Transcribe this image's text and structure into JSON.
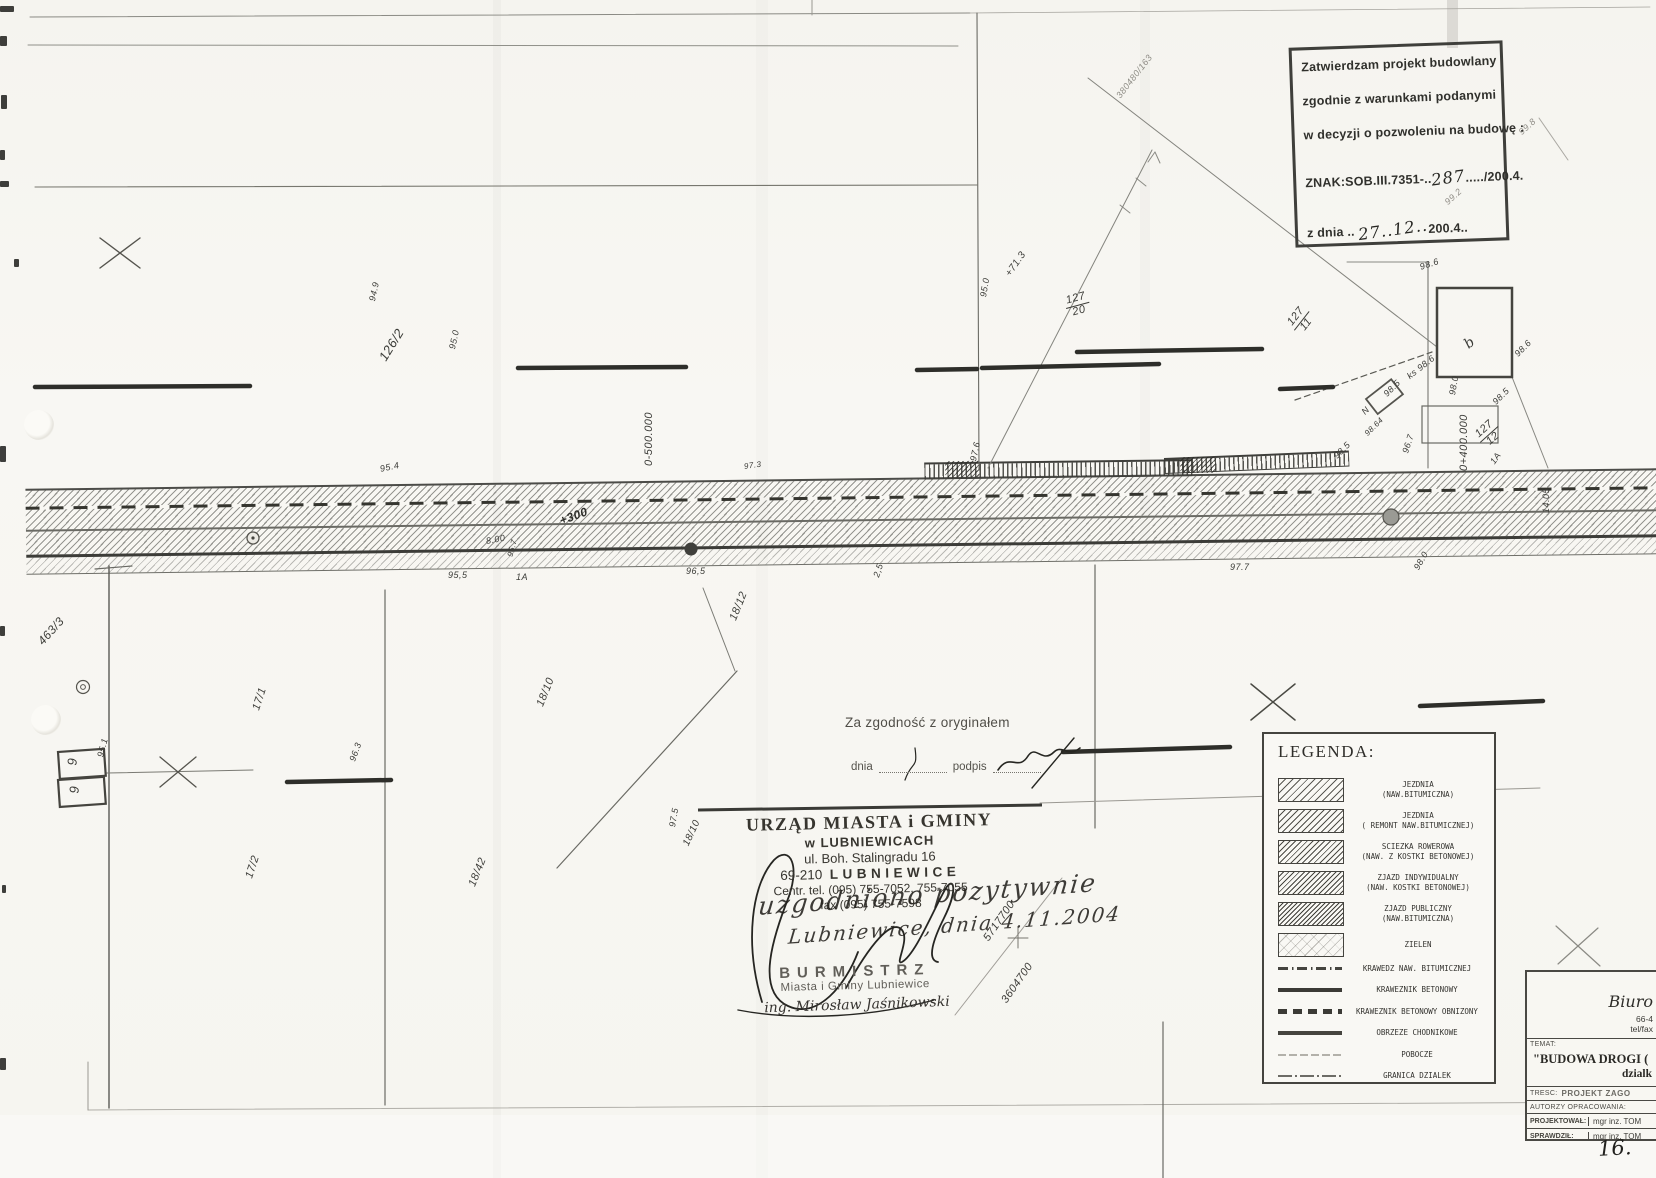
{
  "page": {
    "number": "16."
  },
  "approval_stamp": {
    "line1": "Zatwierdzam projekt budowlany",
    "line2": "zgodnie z warunkami podanymi",
    "line3": "w decyzji o pozwoleniu na budowę :",
    "znak_prefix": "ZNAK:SOB.III.7351-..",
    "znak_hand": "287",
    "znak_suffix": ".....​/200.4.",
    "date_label": "z dnia ..",
    "date_hand": "27..12..",
    "date_suffix": "200.4.."
  },
  "certification": {
    "title": "Za zgodność z oryginałem",
    "dnia_label": "dnia",
    "podpis_label": "podpis"
  },
  "office_stamp": {
    "line1": "URZĄD MIASTA i GMINY",
    "line2": "w LUBNIEWICACH",
    "line3": "ul. Boh. Stalingradu 16",
    "line4_prefix": "69-210",
    "line4_city": "LUBNIEWICE",
    "line5": "Centr. tel. (095) 755-7052, 755-7055",
    "line6": "fax (095) 755-7598"
  },
  "handwriting": {
    "note1": "uzgodniono pozytywnie",
    "note2": "Lubniewice, dnia 4.11.2004"
  },
  "mayor_stamp": {
    "title": "BURMISTRZ",
    "line2": "Miasta i Gminy Lubniewice",
    "line3": "ing. Mirosław Jaśnikowski"
  },
  "legend": {
    "title": "LEGENDA:",
    "items": [
      {
        "type": "swatch",
        "pattern": "sw-hatch1",
        "lines": [
          "JEZDNIA",
          "(NAW.BITUMICZNA)"
        ]
      },
      {
        "type": "swatch",
        "pattern": "sw-hatch2",
        "lines": [
          "JEZDNIA",
          "( REMONT NAW.BITUMICZNEJ)"
        ]
      },
      {
        "type": "swatch",
        "pattern": "sw-hatch3",
        "lines": [
          "SCIEZKA ROWEROWA",
          "(NAW. Z KOSTKI BETONOWEJ)"
        ]
      },
      {
        "type": "swatch",
        "pattern": "sw-hatch4",
        "lines": [
          "ZJAZD INDYWIDUALNY",
          "(NAW. KOSTKI BETONOWEJ)"
        ]
      },
      {
        "type": "swatch",
        "pattern": "sw-hatch5",
        "lines": [
          "ZJAZD PUBLICZNY",
          "(NAW.BITUMICZNA)"
        ]
      },
      {
        "type": "swatch",
        "pattern": "sw-dots",
        "lines": [
          "ZIELEN"
        ]
      },
      {
        "type": "line",
        "pattern": "ln-dashdot",
        "lines": [
          "KRAWEDZ NAW. BITUMICZNEJ"
        ]
      },
      {
        "type": "line",
        "pattern": "ln-solid-thick",
        "lines": [
          "KRAWEZNIK BETONOWY"
        ]
      },
      {
        "type": "line",
        "pattern": "ln-dash-bars",
        "lines": [
          "KRAWEZNIK BETONOWY OBNIZONY"
        ]
      },
      {
        "type": "line",
        "pattern": "ln-solid-med",
        "lines": [
          "OBRZEZE CHODNIKOWE"
        ]
      },
      {
        "type": "line",
        "pattern": "ln-faint",
        "lines": [
          "POBOCZE"
        ]
      },
      {
        "type": "line",
        "pattern": "ln-boundary",
        "lines": [
          "GRANICA DZIALEK"
        ]
      }
    ]
  },
  "title_block": {
    "firm_name": "Biuro",
    "firm_line2": "66-4",
    "firm_line3": "tel/fax",
    "temat_label": "TEMAT:",
    "temat_value": "\"BUDOWA DROGI (",
    "temat_value2": "dzialk",
    "tresc_label": "TRESC:",
    "tresc_value": "PROJEKT ZAGO",
    "autorzy_label": "AUTORZY OPRACOWANIA:",
    "rows": [
      {
        "label": "PROJEKTOWAŁ:",
        "value": "mgr inz. TOM"
      },
      {
        "label": "SPRAWDZIŁ:",
        "value": "mgr inz. TOM"
      }
    ]
  },
  "plan_labels": [
    {
      "text": "126/2",
      "x": 382,
      "y": 352,
      "rot": -58,
      "size": 13
    },
    {
      "text": "94.9",
      "x": 372,
      "y": 296,
      "rot": -78,
      "size": 9
    },
    {
      "text": "95.0",
      "x": 452,
      "y": 344,
      "rot": -78,
      "size": 9
    },
    {
      "text": "0-500.000",
      "x": 649,
      "y": 460,
      "rot": -90,
      "size": 11
    },
    {
      "text": "95.4",
      "x": 380,
      "y": 464,
      "rot": -12,
      "size": 9
    },
    {
      "text": "+300",
      "x": 560,
      "y": 514,
      "rot": -20,
      "size": 12,
      "cls": "bold"
    },
    {
      "text": "8.00",
      "x": 486,
      "y": 536,
      "rot": -10,
      "size": 9
    },
    {
      "text": "95.7",
      "x": 510,
      "y": 552,
      "rot": -75,
      "size": 8
    },
    {
      "text": "97.3",
      "x": 744,
      "y": 462,
      "rot": -8,
      "size": 8
    },
    {
      "text": "95,5",
      "x": 448,
      "y": 570,
      "rot": 0,
      "size": 9
    },
    {
      "text": "1A",
      "x": 516,
      "y": 572,
      "rot": 0,
      "size": 9
    },
    {
      "text": "96,5",
      "x": 686,
      "y": 566,
      "rot": 0,
      "size": 9
    },
    {
      "text": "2,5",
      "x": 876,
      "y": 572,
      "rot": -72,
      "size": 9
    },
    {
      "text": "97.6",
      "x": 973,
      "y": 456,
      "rot": -78,
      "size": 9
    },
    {
      "text": "95.0",
      "x": 983,
      "y": 292,
      "rot": -80,
      "size": 9
    },
    {
      "text": "+71.3",
      "x": 1008,
      "y": 270,
      "rot": -55,
      "size": 10
    },
    {
      "text": "380480/163",
      "x": 1118,
      "y": 92,
      "rot": -52,
      "size": 9,
      "cls": "faint"
    },
    {
      "text": "99.8",
      "x": 1520,
      "y": 128,
      "rot": -42,
      "size": 9,
      "cls": "faint"
    },
    {
      "text": "99.2",
      "x": 1446,
      "y": 198,
      "rot": -42,
      "size": 9,
      "cls": "faint"
    },
    {
      "text": "98.6",
      "x": 1420,
      "y": 262,
      "rot": -18,
      "size": 9
    },
    {
      "text": "98.6",
      "x": 1516,
      "y": 350,
      "rot": -45,
      "size": 9
    },
    {
      "text": "ks 98.6",
      "x": 1408,
      "y": 372,
      "rot": -38,
      "size": 9
    },
    {
      "text": "98.5",
      "x": 1385,
      "y": 390,
      "rot": -45,
      "size": 9
    },
    {
      "text": "N",
      "x": 1363,
      "y": 408,
      "rot": -45,
      "size": 9
    },
    {
      "text": "98.5",
      "x": 1335,
      "y": 452,
      "rot": -45,
      "size": 9
    },
    {
      "text": "98.64",
      "x": 1366,
      "y": 430,
      "rot": -45,
      "size": 8
    },
    {
      "text": "98.0",
      "x": 1452,
      "y": 390,
      "rot": -80,
      "size": 9
    },
    {
      "text": "98.5",
      "x": 1494,
      "y": 398,
      "rot": -45,
      "size": 9
    },
    {
      "text": "96.7",
      "x": 1405,
      "y": 448,
      "rot": -72,
      "size": 9
    },
    {
      "text": "1A",
      "x": 1492,
      "y": 458,
      "rot": -55,
      "size": 9
    },
    {
      "text": "0+400.000",
      "x": 1464,
      "y": 465,
      "rot": -90,
      "size": 11
    },
    {
      "text": "14.05",
      "x": 1546,
      "y": 508,
      "rot": -90,
      "size": 9
    },
    {
      "text": "97.7",
      "x": 1230,
      "y": 562,
      "rot": 0,
      "size": 9
    },
    {
      "text": "98.0",
      "x": 1416,
      "y": 564,
      "rot": -60,
      "size": 9
    },
    {
      "text": "b",
      "x": 1466,
      "y": 338,
      "rot": -38,
      "size": 14,
      "cls": "serif"
    },
    {
      "text": "463/3",
      "x": 40,
      "y": 636,
      "rot": -48,
      "size": 12
    },
    {
      "text": "95.1",
      "x": 100,
      "y": 752,
      "rot": -75,
      "size": 9
    },
    {
      "text": "17/1",
      "x": 256,
      "y": 704,
      "rot": -72,
      "size": 11
    },
    {
      "text": "17/2",
      "x": 249,
      "y": 872,
      "rot": -72,
      "size": 11
    },
    {
      "text": "18/12",
      "x": 733,
      "y": 614,
      "rot": -68,
      "size": 11
    },
    {
      "text": "18/10",
      "x": 540,
      "y": 700,
      "rot": -68,
      "size": 11
    },
    {
      "text": "18/42",
      "x": 472,
      "y": 880,
      "rot": -68,
      "size": 11
    },
    {
      "text": "18/10",
      "x": 686,
      "y": 840,
      "rot": -65,
      "size": 10
    },
    {
      "text": "96.3",
      "x": 352,
      "y": 756,
      "rot": -70,
      "size": 9
    },
    {
      "text": "97.5",
      "x": 672,
      "y": 822,
      "rot": -80,
      "size": 9
    },
    {
      "text": "5717700",
      "x": 986,
      "y": 934,
      "rot": -55,
      "size": 11
    },
    {
      "text": "3604700",
      "x": 1004,
      "y": 996,
      "rot": -55,
      "size": 11
    },
    {
      "text": "127",
      "den": "20",
      "x": 1066,
      "y": 296,
      "rot": -15,
      "size": 11
    },
    {
      "text": "127",
      "den": "11",
      "x": 1294,
      "y": 318,
      "rot": -52,
      "size": 11
    },
    {
      "text": "127",
      "den": "12",
      "x": 1480,
      "y": 430,
      "rot": -42,
      "size": 11
    },
    {
      "text": "9",
      "x": 72,
      "y": 758,
      "rot": -88,
      "size": 13
    },
    {
      "text": "9",
      "x": 74,
      "y": 786,
      "rot": -88,
      "size": 13
    }
  ]
}
